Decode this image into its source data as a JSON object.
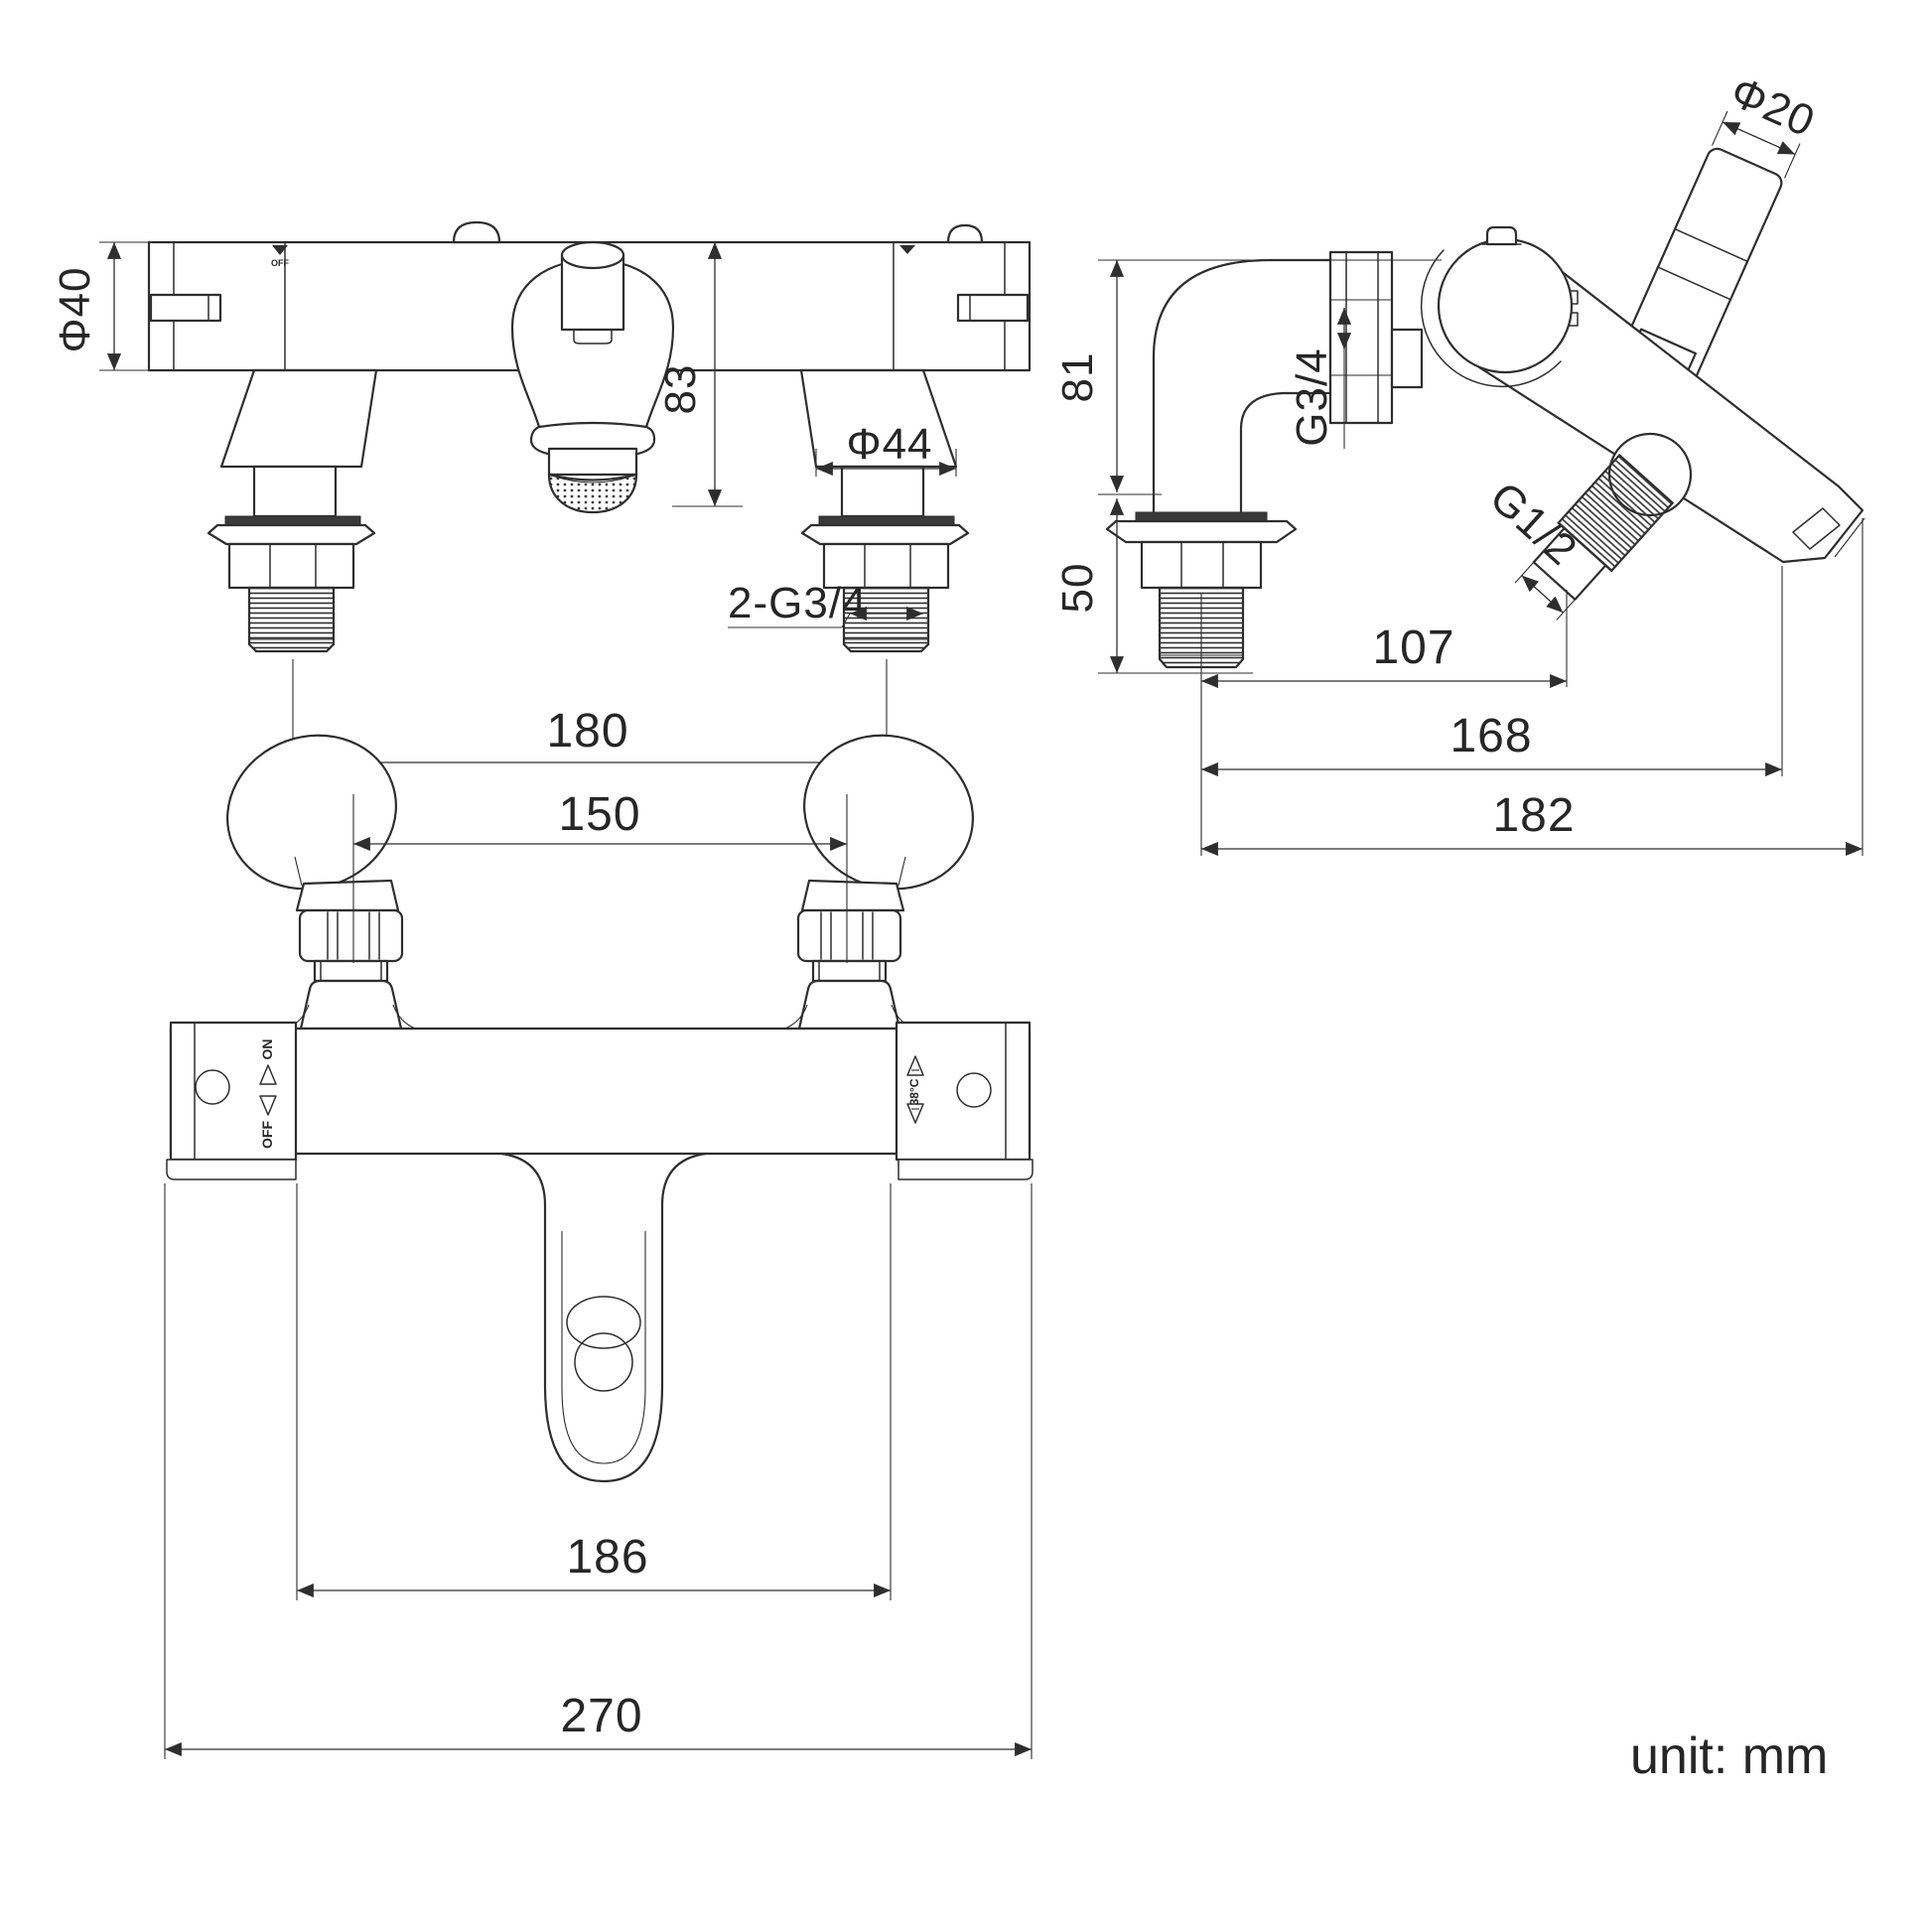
{
  "front": {
    "dia_cartridge": "Φ40",
    "height": "83",
    "base_dia": "Φ44",
    "inlet_thread": "2-G3/4",
    "inlet_spacing": "180",
    "marker_off": "OFF"
  },
  "side": {
    "handle_dia": "Φ20",
    "upper_height": "81",
    "inlet_thread": "G3/4",
    "shower_thread": "G1/2",
    "lower_height": "50",
    "outlet_reach": "107",
    "spout_reach": "168",
    "total_reach": "182"
  },
  "plan": {
    "handle_spacing": "150",
    "centers_width": "186",
    "overall_width": "270",
    "on_label": "ON",
    "off_label": "OFF",
    "temp_label": "38°C"
  },
  "unit_label": "unit: mm"
}
